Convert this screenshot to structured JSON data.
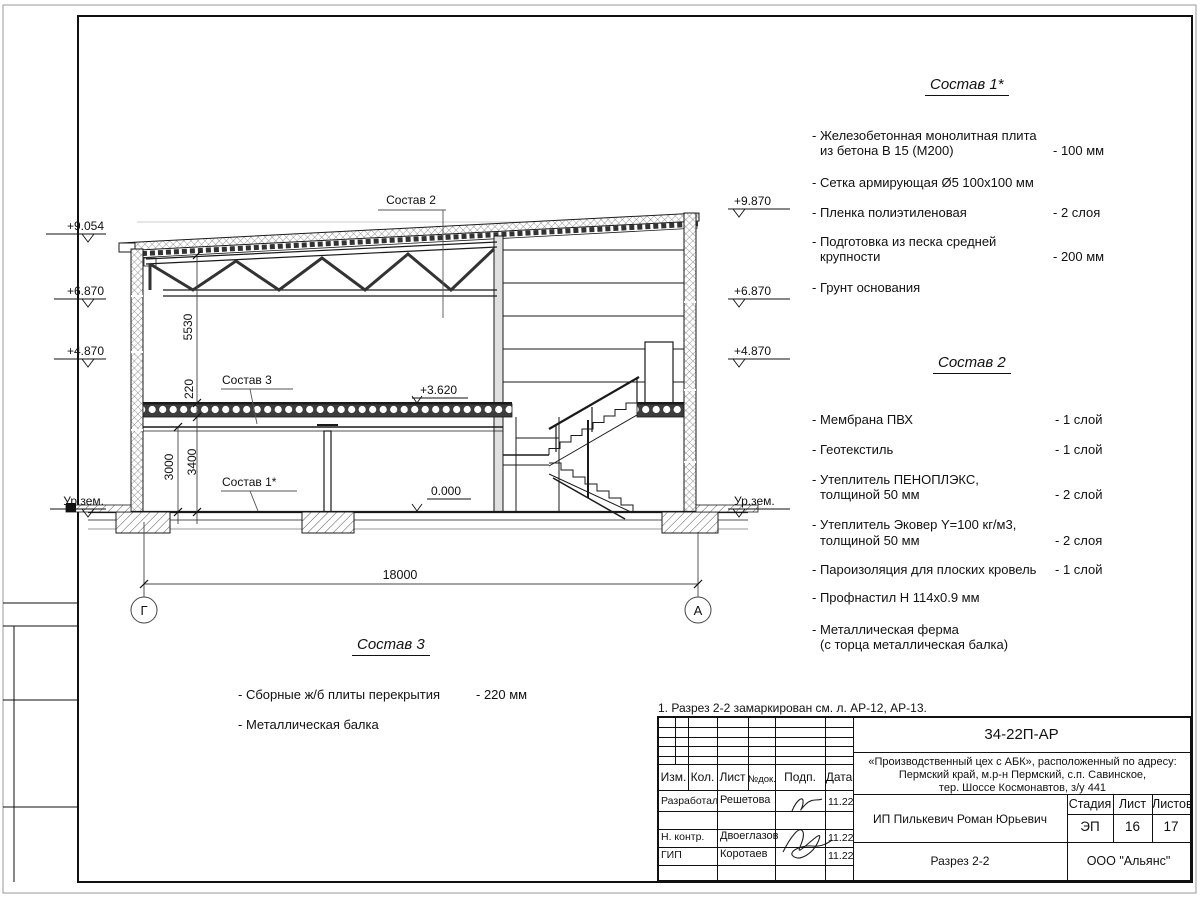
{
  "note": "1. Разрез 2-2 замаркирован см. л. АР-12, АР-13.",
  "lists": {
    "sostav1": {
      "title": "Состав 1*",
      "items": [
        {
          "l1": "- Железобетонная  монолитная плита",
          "l2": "из бетона В 15 (М200)",
          "v": "- 100 мм"
        },
        {
          "l1": "- Сетка армирующая Ø5 100x100 мм",
          "v": ""
        },
        {
          "l1": "- Пленка полиэтиленовая",
          "v": "- 2 слоя"
        },
        {
          "l1": "- Подготовка из песка средней",
          "l2": "крупности",
          "v": "- 200 мм"
        },
        {
          "l1": "- Грунт основания",
          "v": ""
        }
      ]
    },
    "sostav2": {
      "title": "Состав 2",
      "items": [
        {
          "l1": "- Мембрана ПВХ",
          "v": "- 1 слой"
        },
        {
          "l1": "- Геотекстиль",
          "v": "- 1 слой"
        },
        {
          "l1": "- Утеплитель ПЕНОПЛЭКС,",
          "l2": "толщиной 50 мм",
          "v": "- 2 слой"
        },
        {
          "l1": "- Утеплитель Эковер Y=100 кг/м3,",
          "l2": "толщиной 50 мм",
          "v": "- 2 слоя"
        },
        {
          "l1": "- Пароизоляция для плоских кровель",
          "v": "- 1 слой"
        },
        {
          "l1": "- Профнастил Н 114x0.9 мм",
          "v": ""
        },
        {
          "l1": "- Металлическая ферма",
          "l2": "(с торца металлическая балка)",
          "v": ""
        }
      ]
    },
    "sostav3": {
      "title": "Состав 3",
      "items": [
        {
          "l1": "- Сборные ж/б  плиты перекрытия",
          "v": "- 220 мм"
        },
        {
          "l1": "- Металлическая балка",
          "v": ""
        }
      ]
    }
  },
  "drawing": {
    "callouts": {
      "sostav2": "Состав 2",
      "sostav3": "Состав 3",
      "sostav1": "Состав 1*"
    },
    "elevations": {
      "left": [
        "+9.054",
        "+6.870",
        "+4.870",
        "Ур.зем."
      ],
      "right": [
        "+9.870",
        "+6.870",
        "+4.870",
        "Ур.зем."
      ],
      "slab": "+3.620",
      "floor": "0.000"
    },
    "dimensions": {
      "span": "18000",
      "roof_height": "5530",
      "slab_thk": "220",
      "clear_height": "3000",
      "floor_height": "3400"
    },
    "axes": {
      "left": "Г",
      "right": "А"
    }
  },
  "titleblock": {
    "doc_number": "34-22П-АР",
    "project_line1": "«Производственный цех с АБК», расположенный по адресу:",
    "project_line2": "Пермский край, м.р-н Пермский, с.п. Савинское,",
    "project_line3": "тер. Шоссе Космонавтов, з/у 441",
    "client": "ИП Пилькевич Роман Юрьевич",
    "sheet_title": "Разрез 2-2",
    "company": "ООО \"Альянс\"",
    "headers": {
      "izm": "Изм.",
      "kol": "Кол.",
      "list": "Лист",
      "ndok": "№док.",
      "podp": "Подп.",
      "data": "Дата",
      "stadia": "Стадия",
      "sheet": "Лист",
      "sheets": "Листов"
    },
    "stadia_value": "ЭП",
    "sheet_value": "16",
    "sheets_value": "17",
    "rows": [
      {
        "role": "Разработал",
        "name": "Решетова",
        "date": "11.22"
      },
      {
        "role": "Н. контр.",
        "name": "Двоеглазов",
        "date": "11.22"
      },
      {
        "role": "ГИП",
        "name": "Коротаев",
        "date": "11.22"
      }
    ]
  }
}
